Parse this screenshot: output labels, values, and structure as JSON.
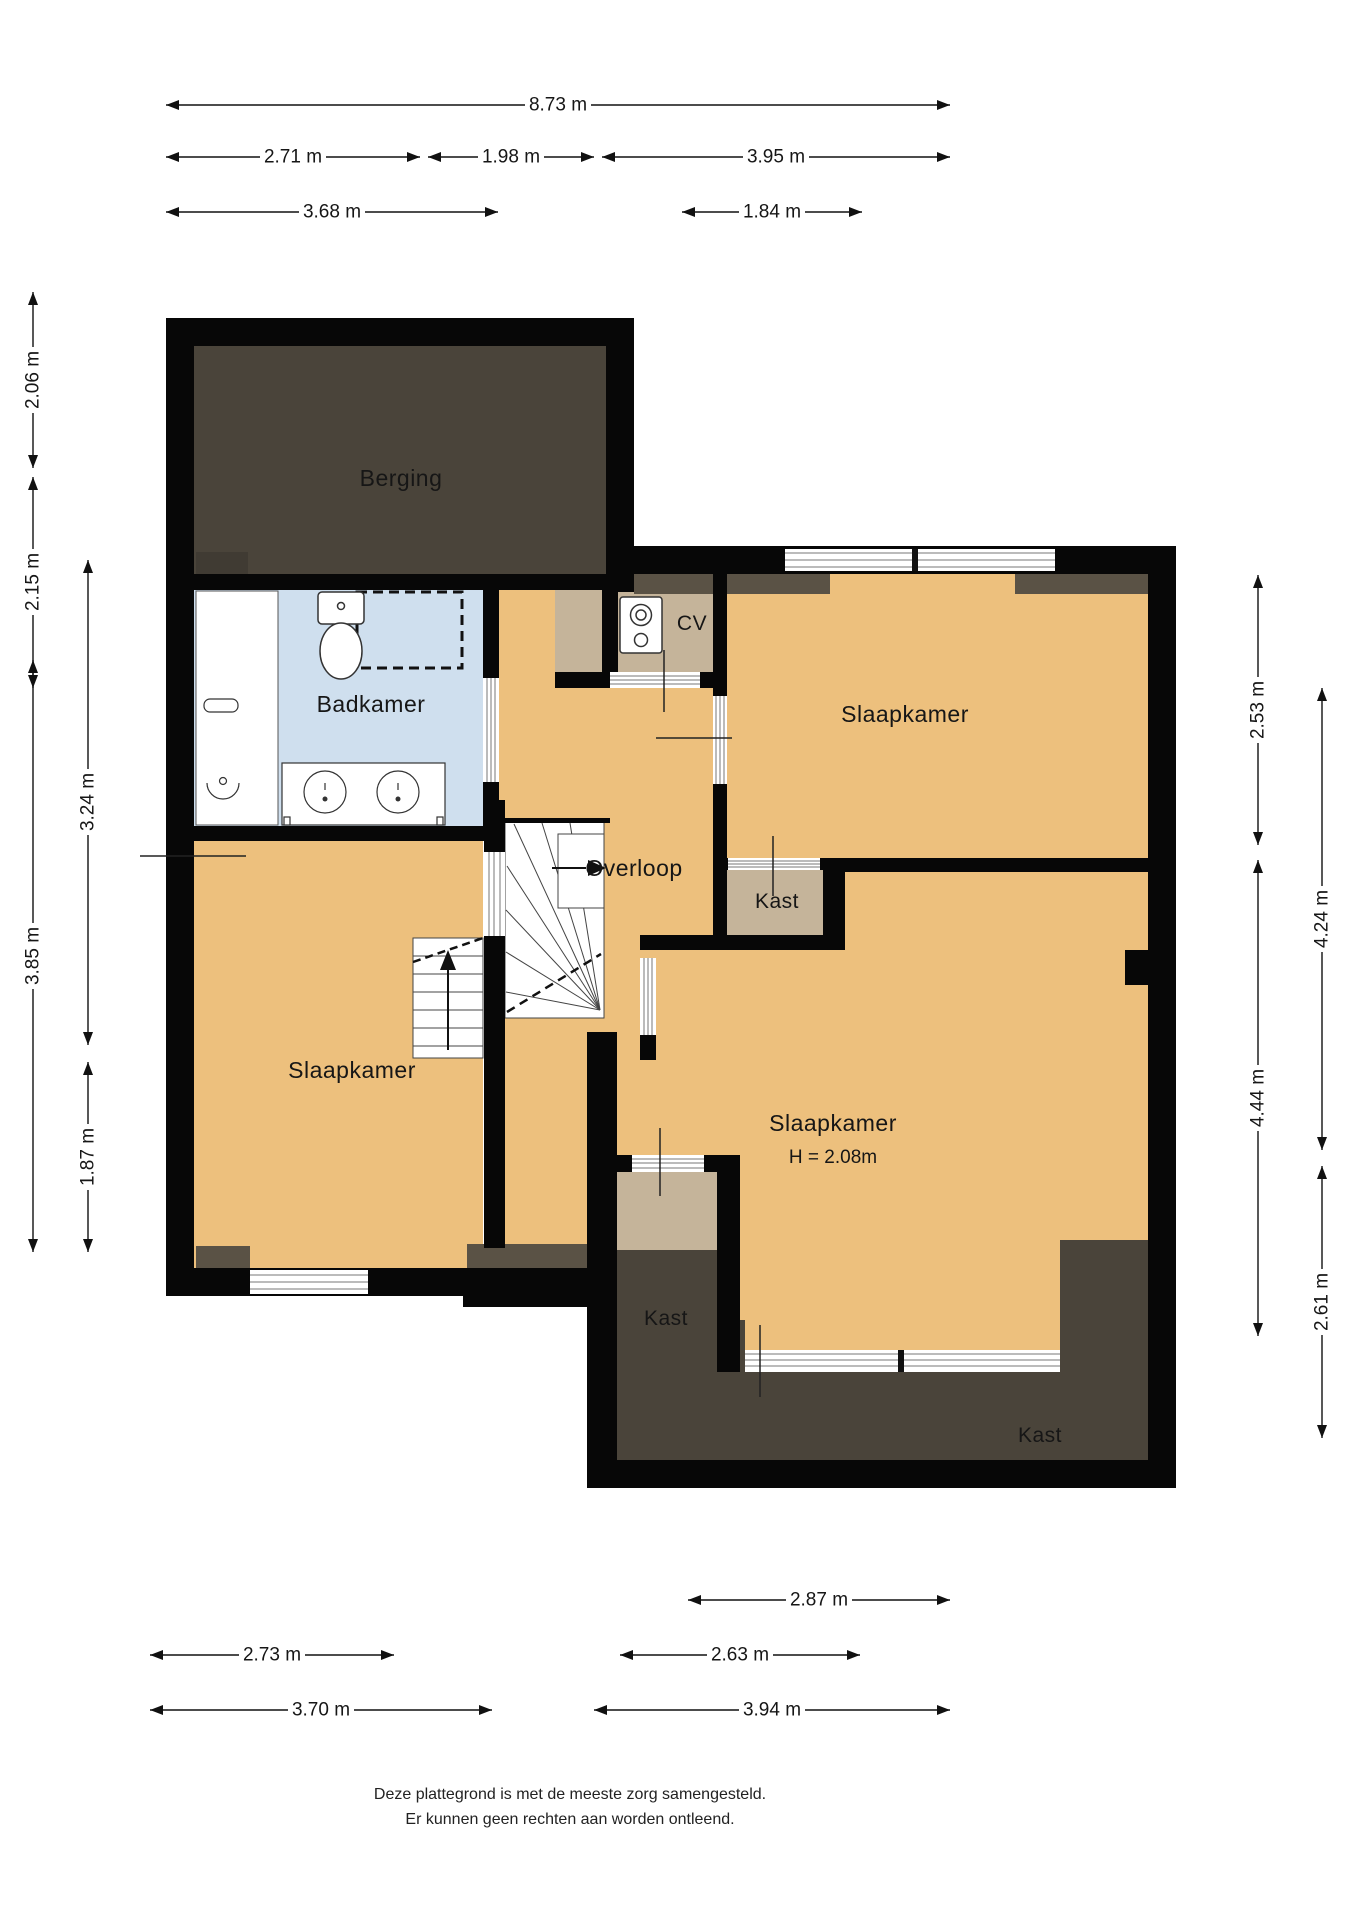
{
  "floorplan": {
    "rooms": {
      "berging": {
        "label": "Berging"
      },
      "badkamer": {
        "label": "Badkamer"
      },
      "cv": {
        "label": "CV"
      },
      "overloop": {
        "label": "Overloop"
      },
      "slaapkamer_noord": {
        "label": "Slaapkamer"
      },
      "slaapkamer_west": {
        "label": "Slaapkamer"
      },
      "slaapkamer_zuid": {
        "label": "Slaapkamer",
        "height_note": "H = 2.08m"
      },
      "kast_overloop": {
        "label": "Kast"
      },
      "kast_midden": {
        "label": "Kast"
      },
      "kast_zuid": {
        "label": "Kast"
      }
    },
    "dimensions": [
      {
        "value": "8.73 m",
        "orient": "h",
        "a": 166,
        "b": 950,
        "p": 105,
        "l": 558
      },
      {
        "value": "2.71 m",
        "orient": "h",
        "a": 166,
        "b": 420,
        "p": 157,
        "l": 293
      },
      {
        "value": "1.98 m",
        "orient": "h",
        "a": 428,
        "b": 594,
        "p": 157,
        "l": 511
      },
      {
        "value": "3.95 m",
        "orient": "h",
        "a": 602,
        "b": 950,
        "p": 157,
        "l": 776
      },
      {
        "value": "3.68 m",
        "orient": "h",
        "a": 166,
        "b": 498,
        "p": 212,
        "l": 332
      },
      {
        "value": "1.84 m",
        "orient": "h",
        "a": 682,
        "b": 862,
        "p": 212,
        "l": 772
      },
      {
        "value": "2.06 m",
        "orient": "v",
        "a": 292,
        "b": 468,
        "p": 33,
        "l": 380
      },
      {
        "value": "2.15 m",
        "orient": "v",
        "a": 477,
        "b": 688,
        "p": 33,
        "l": 582
      },
      {
        "value": "3.85 m",
        "orient": "v",
        "a": 660,
        "b": 1252,
        "p": 33,
        "l": 956
      },
      {
        "value": "3.24 m",
        "orient": "v",
        "a": 560,
        "b": 1045,
        "p": 88,
        "l": 802
      },
      {
        "value": "1.87 m",
        "orient": "v",
        "a": 1062,
        "b": 1252,
        "p": 88,
        "l": 1157
      },
      {
        "value": "2.53 m",
        "orient": "v",
        "a": 575,
        "b": 845,
        "p": 1258,
        "l": 710
      },
      {
        "value": "4.44 m",
        "orient": "v",
        "a": 860,
        "b": 1336,
        "p": 1258,
        "l": 1098
      },
      {
        "value": "4.24 m",
        "orient": "v",
        "a": 688,
        "b": 1150,
        "p": 1322,
        "l": 919
      },
      {
        "value": "2.61 m",
        "orient": "v",
        "a": 1166,
        "b": 1438,
        "p": 1322,
        "l": 1302
      },
      {
        "value": "2.87 m",
        "orient": "h",
        "a": 688,
        "b": 950,
        "p": 1600,
        "l": 819
      },
      {
        "value": "2.73 m",
        "orient": "h",
        "a": 150,
        "b": 394,
        "p": 1655,
        "l": 272
      },
      {
        "value": "2.63 m",
        "orient": "h",
        "a": 620,
        "b": 860,
        "p": 1655,
        "l": 740
      },
      {
        "value": "3.70 m",
        "orient": "h",
        "a": 150,
        "b": 492,
        "p": 1710,
        "l": 321
      },
      {
        "value": "3.94 m",
        "orient": "h",
        "a": 594,
        "b": 950,
        "p": 1710,
        "l": 772
      }
    ],
    "footer": {
      "line1": "Deze plattegrond is met de meeste zorg samengesteld.",
      "line2": "Er kunnen geen rechten aan worden ontleend."
    },
    "colors": {
      "wall": "#070707",
      "floor_orange": "#edc07d",
      "floor_taupe": "#c5b49a",
      "floor_blue": "#cfdfee",
      "dark_room": "#4a443a",
      "dark_strip": "#5a5245"
    }
  }
}
